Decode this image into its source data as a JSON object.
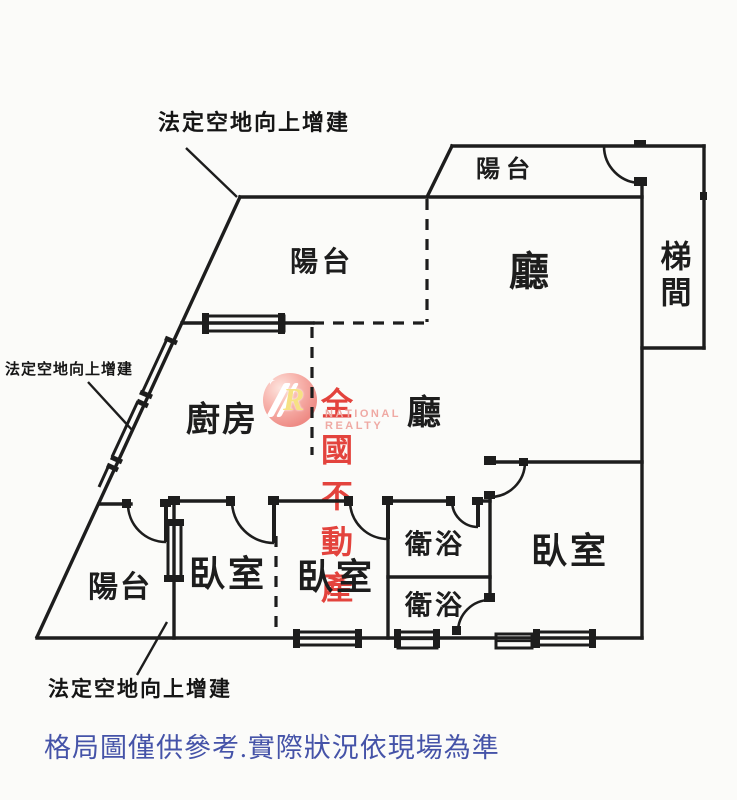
{
  "page": {
    "background": "#fbfbf9",
    "line_color": "#1d1d1d"
  },
  "annotations": {
    "top": "法定空地向上增建",
    "left": "法定空地向上增建",
    "bottom": "法定空地向上增建"
  },
  "rooms": {
    "balcony_top": "陽台",
    "living_room": "廳",
    "stairwell": "梯間",
    "balcony_middle": "陽台",
    "kitchen": "廚房",
    "dining_hall": "廳",
    "bathroom_upper": "衛浴",
    "bathroom_lower": "衛浴",
    "bedroom_left": "臥室",
    "bedroom_middle": "臥室",
    "bedroom_right": "臥室",
    "balcony_bottom": "陽台"
  },
  "watermark": {
    "logo_letter": "R",
    "brand": "全國不動產",
    "brand_en": "NATIONAL REALTY",
    "brand_color": "#e23a33",
    "brand_en_color": "#efa9a3",
    "logo_color": "#f0918c"
  },
  "disclaimer": {
    "text": "格局圖僅供參考.實際狀況依現場為準",
    "color": "#4553a8"
  }
}
